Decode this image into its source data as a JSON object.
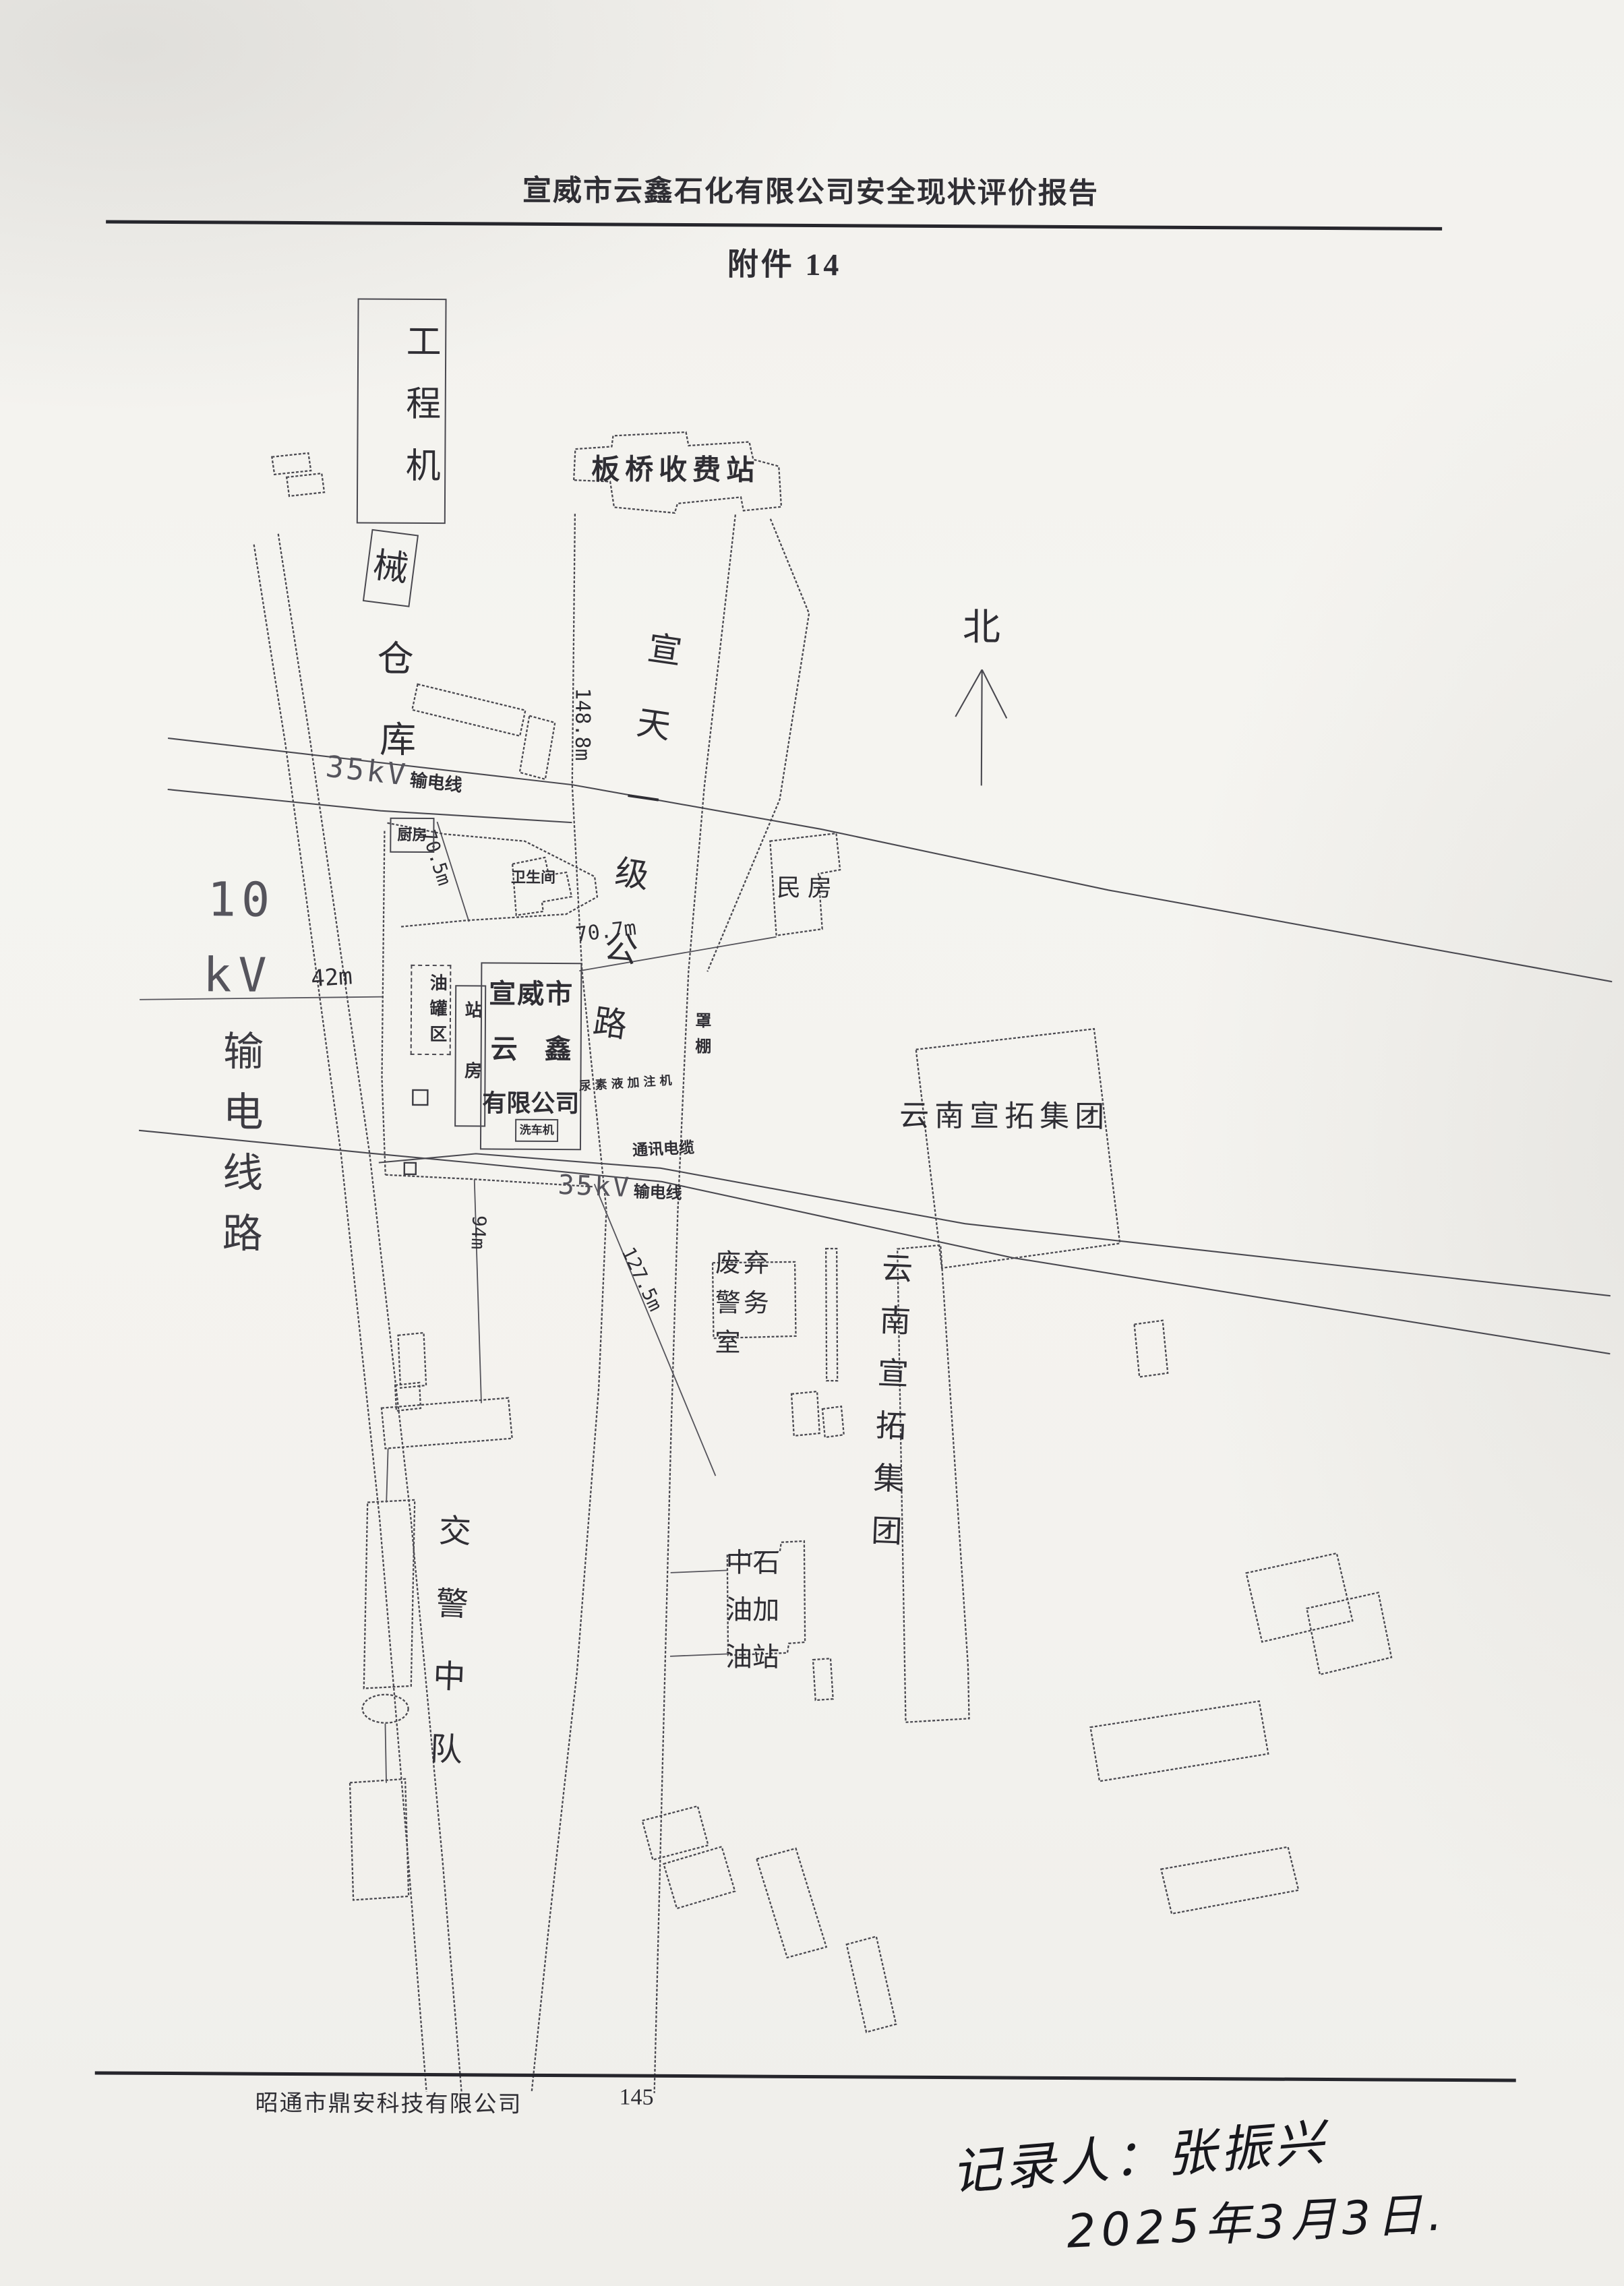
{
  "page": {
    "header": "宣威市云鑫石化有限公司安全现状评价报告",
    "attachment_title": "附件 14",
    "footer_company": "昭通市鼎安科技有限公司",
    "page_number": "145",
    "handwritten_note": {
      "line1": "记录人：张振兴",
      "line2": "2025年3月3日."
    }
  },
  "map": {
    "north_label": "北",
    "toll_station": "板桥收费站",
    "road_name": "宣天一级公路",
    "machinery_warehouse": {
      "part1": "工程机",
      "part2": "械",
      "part3": "仓",
      "part4": "库"
    },
    "power_35kv": {
      "value": "35kV",
      "label": "输电线"
    },
    "power_10kv": {
      "value1": "10",
      "value2": "kV",
      "label": "输电线路"
    },
    "comm_cable": "通讯电缆",
    "company": {
      "line1": "宣威市",
      "line2": "云　鑫",
      "line3": "有限公司"
    },
    "kitchen": "厨房",
    "restroom": "卫生间",
    "tank_area": "油罐区",
    "station_house": "站房",
    "canopy": "罩棚",
    "urea_machine": "尿素液加注机",
    "car_washer": "洗车机",
    "residence": "民房",
    "abandoned_police_office": "废弃警务室",
    "yunnan_xuantuo_group_h": "云南宣拓集团",
    "yunnan_xuantuo_group_v": "云南宣拓集团",
    "cnpc_gas_station": "中石油加油站",
    "traffic_police_squadron": "交警中队",
    "measurements": {
      "d1": "148.8m",
      "d2": "70.7m",
      "d3": "70.5m",
      "d4": "42m",
      "d5": "94m",
      "d6": "127.5m"
    }
  }
}
